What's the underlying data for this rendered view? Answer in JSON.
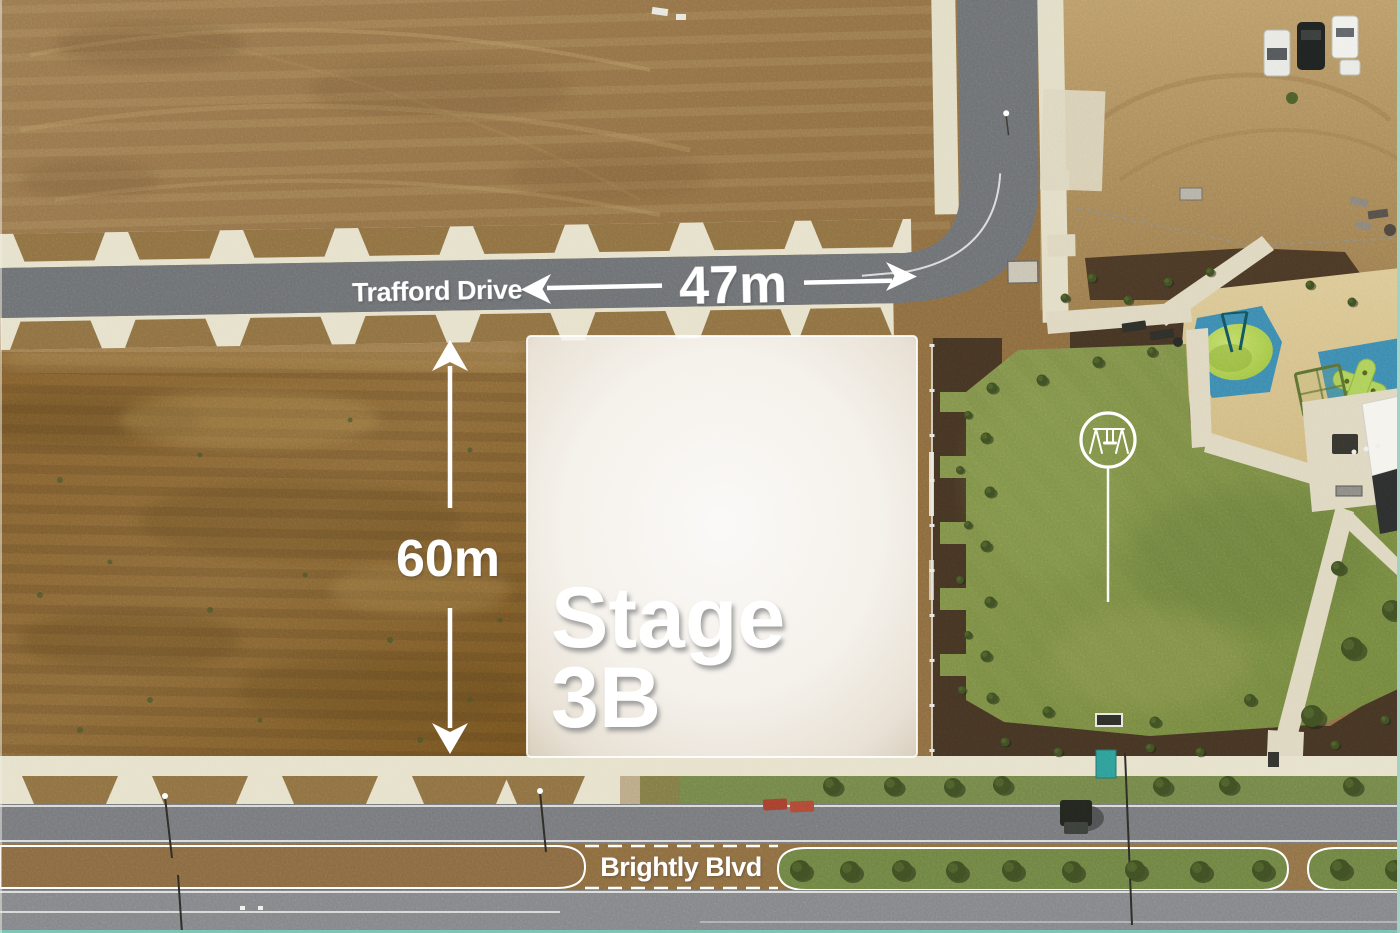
{
  "annotations": {
    "street_top": "Trafford Drive",
    "width_label": "47m",
    "height_label": "60m",
    "stage_line1": "Stage",
    "stage_line2": "3B",
    "street_bottom": "Brightly Blvd"
  },
  "icons": {
    "playground_callout": "swing-icon"
  },
  "colors": {
    "annotation_white": "#ffffff",
    "stage_overlay": "#f7f5f0",
    "asphalt": "#75777b",
    "concrete_path": "#e6e1cb",
    "dirt_light": "#a9885a",
    "dirt_dark": "#7c5c31",
    "lawn_green": "#7e9049",
    "softfall_blue": "#3d8bb0",
    "equipment_lime": "#a9cc55",
    "mulch_brown": "#463524",
    "border_teal": "#7fc4b4"
  }
}
